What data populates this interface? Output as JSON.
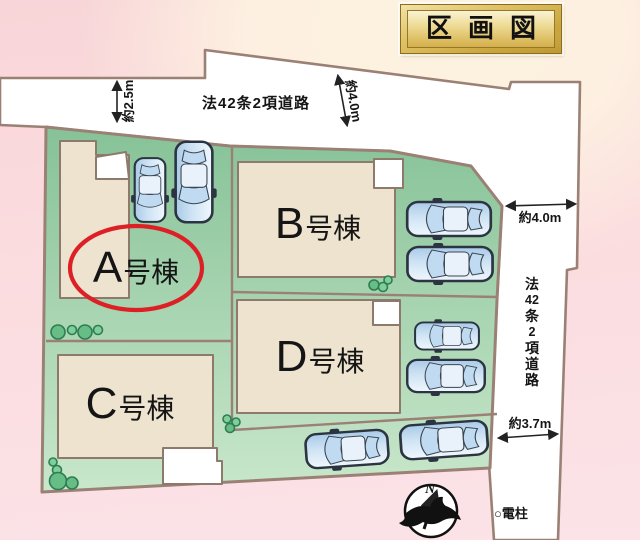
{
  "title": "区画図",
  "plots": [
    {
      "name": "A",
      "letter": "A",
      "suffix": "号棟",
      "highlighted": true
    },
    {
      "name": "B",
      "letter": "B",
      "suffix": "号棟",
      "highlighted": false
    },
    {
      "name": "C",
      "letter": "C",
      "suffix": "号棟",
      "highlighted": false
    },
    {
      "name": "D",
      "letter": "D",
      "suffix": "号棟",
      "highlighted": false
    }
  ],
  "roads": {
    "top": {
      "label": "法42条2項道路"
    },
    "right": {
      "label": "法42条2項道路",
      "chars": [
        "法",
        "42",
        "条",
        "2",
        "項",
        "道",
        "路"
      ]
    }
  },
  "measurements": {
    "top_left": "約2.5m",
    "top_right": "約4.0m",
    "right": "約4.0m",
    "bottom_right": "約3.7m"
  },
  "labels": {
    "utility_pole": "○電柱",
    "compass_north": "N"
  },
  "icons": {
    "compass": "compass-north-icon",
    "tree": "tree-icon",
    "car": "car-icon"
  },
  "counts": {
    "buildings": 4,
    "cars": 8
  },
  "colors": {
    "site_green_top": "#88C499",
    "site_green_bottom": "#C9E7CB",
    "building_fill": "#EDE3CF",
    "outline_brown": "#9B8075",
    "highlight_red": "#DD2025",
    "background_pink": "#F8D5D8",
    "background_cream": "#FDF2E0",
    "title_gold": "#C9A53C",
    "car_blue": "#AECDE9"
  }
}
